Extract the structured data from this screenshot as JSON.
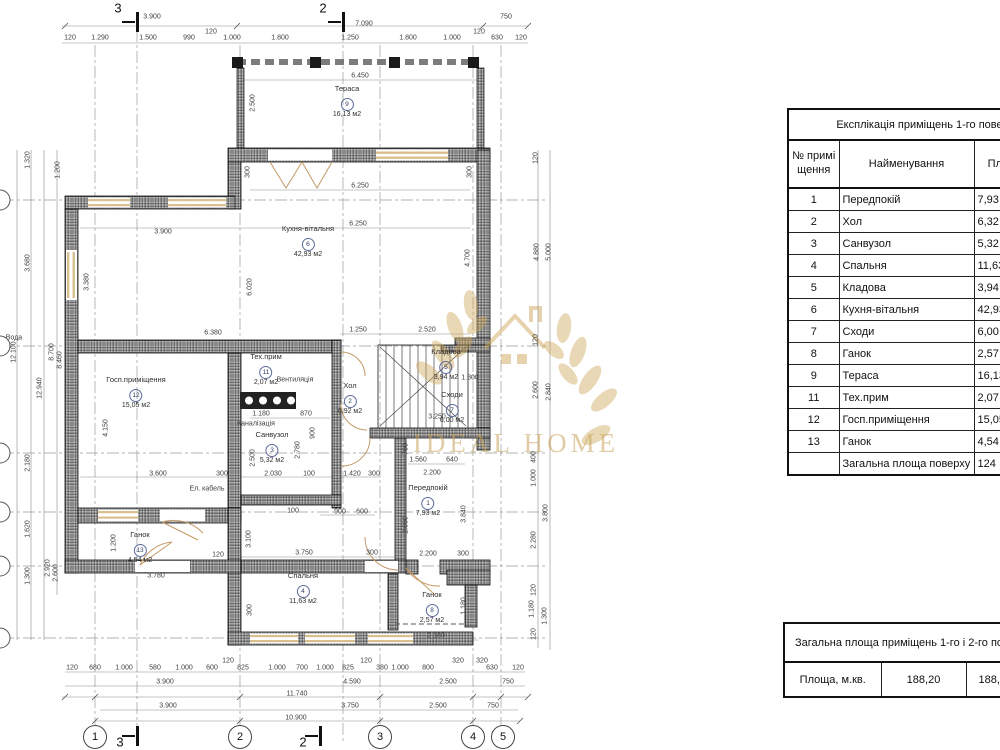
{
  "watermark": {
    "brand": "IDEAL HOME",
    "color": "#c9a45c"
  },
  "tables": {
    "explication": {
      "title": "Експлікація приміщень 1-го поверху",
      "columns": [
        "№ приміщення",
        "Найменування",
        "Площа, м.кв."
      ],
      "rows": [
        {
          "num": "1",
          "name": "Передпокій",
          "area": "7,93"
        },
        {
          "num": "2",
          "name": "Хол",
          "area": "6,32"
        },
        {
          "num": "3",
          "name": "Санвузол",
          "area": "5,32"
        },
        {
          "num": "4",
          "name": "Спальня",
          "area": "11,63"
        },
        {
          "num": "5",
          "name": "Кладова",
          "area": "3,94"
        },
        {
          "num": "6",
          "name": "Кухня-вітальня",
          "area": "42,93"
        },
        {
          "num": "7",
          "name": "Сходи",
          "area": "6,00"
        },
        {
          "num": "8",
          "name": "Ганок",
          "area": "2,57"
        },
        {
          "num": "9",
          "name": "Тераса",
          "area": "16,13"
        },
        {
          "num": "11",
          "name": "Тех.прим",
          "area": "2,07"
        },
        {
          "num": "12",
          "name": "Госп.приміщення",
          "area": "15,05"
        },
        {
          "num": "13",
          "name": "Ганок",
          "area": "4,54"
        },
        {
          "num": "",
          "name": "Загальна площа поверху",
          "area": "124"
        }
      ]
    },
    "total": {
      "title": "Загальна площа приміщень 1-го і 2-го поверхів",
      "row_label": "Площа, м.кв.",
      "value1": "188,20",
      "value2": "188,20"
    }
  },
  "plan": {
    "rooms": [
      {
        "name": "Тераса",
        "num": "9",
        "area": "16,13 м2",
        "x": 347,
        "y": 84
      },
      {
        "name": "Кухня-вітальня",
        "num": "6",
        "area": "42,93 м2",
        "x": 308,
        "y": 224
      },
      {
        "name": "Госп.приміщення",
        "num": "12",
        "area": "15,05 м2",
        "x": 136,
        "y": 375
      },
      {
        "name": "Тех.прим",
        "num": "11",
        "area": "2,07 м2",
        "x": 266,
        "y": 352
      },
      {
        "name": "Хол",
        "num": "2",
        "area": "6,92 м2",
        "x": 350,
        "y": 381
      },
      {
        "name": "Санвузол",
        "num": "3",
        "area": "5,32 м2",
        "x": 272,
        "y": 430
      },
      {
        "name": "Кладова",
        "num": "5",
        "area": "3,94 м2",
        "x": 446,
        "y": 347
      },
      {
        "name": "Сходи",
        "num": "7",
        "area": "6,00 м2",
        "x": 452,
        "y": 390
      },
      {
        "name": "Передпокій",
        "num": "1",
        "area": "7,93 м2",
        "x": 428,
        "y": 483
      },
      {
        "name": "Спальня",
        "num": "4",
        "area": "11,63 м2",
        "x": 303,
        "y": 571
      },
      {
        "name": "Ганок",
        "num": "13",
        "area": "4,54 м2",
        "x": 140,
        "y": 530
      },
      {
        "name": "Ганок",
        "num": "8",
        "area": "2,57 м2",
        "x": 432,
        "y": 590
      }
    ],
    "dims": [
      {
        "t": "3.900",
        "x": 152,
        "y": 17
      },
      {
        "t": "7.090",
        "x": 364,
        "y": 24
      },
      {
        "t": "750",
        "x": 506,
        "y": 17
      },
      {
        "t": "120",
        "x": 70,
        "y": 38
      },
      {
        "t": "1.290",
        "x": 100,
        "y": 38
      },
      {
        "t": "1.500",
        "x": 148,
        "y": 38
      },
      {
        "t": "990",
        "x": 189,
        "y": 38
      },
      {
        "t": "120",
        "x": 211,
        "y": 32
      },
      {
        "t": "1.000",
        "x": 232,
        "y": 38
      },
      {
        "t": "1.800",
        "x": 280,
        "y": 38
      },
      {
        "t": "1.250",
        "x": 350,
        "y": 38
      },
      {
        "t": "1.800",
        "x": 408,
        "y": 38
      },
      {
        "t": "1.000",
        "x": 452,
        "y": 38
      },
      {
        "t": "120",
        "x": 479,
        "y": 32
      },
      {
        "t": "630",
        "x": 497,
        "y": 38
      },
      {
        "t": "120",
        "x": 521,
        "y": 38
      },
      {
        "t": "6.450",
        "x": 360,
        "y": 76
      },
      {
        "t": "2.500",
        "x": 253,
        "y": 103,
        "r": 1
      },
      {
        "t": "6.250",
        "x": 360,
        "y": 186
      },
      {
        "t": "6.250",
        "x": 358,
        "y": 224
      },
      {
        "t": "300",
        "x": 248,
        "y": 172,
        "r": 1
      },
      {
        "t": "300",
        "x": 470,
        "y": 172,
        "r": 1
      },
      {
        "t": "3.900",
        "x": 163,
        "y": 232
      },
      {
        "t": "3.380",
        "x": 87,
        "y": 282,
        "r": 1
      },
      {
        "t": "6.020",
        "x": 250,
        "y": 287,
        "r": 1
      },
      {
        "t": "4.700",
        "x": 468,
        "y": 258,
        "r": 1
      },
      {
        "t": "6.380",
        "x": 213,
        "y": 333
      },
      {
        "t": "1.250",
        "x": 358,
        "y": 330
      },
      {
        "t": "2.520",
        "x": 427,
        "y": 330
      },
      {
        "t": "4.150",
        "x": 106,
        "y": 428,
        "r": 1
      },
      {
        "t": "1.180",
        "x": 261,
        "y": 414
      },
      {
        "t": "870",
        "x": 306,
        "y": 414
      },
      {
        "t": "2.500",
        "x": 253,
        "y": 458,
        "r": 1
      },
      {
        "t": "2.780",
        "x": 298,
        "y": 450,
        "r": 1
      },
      {
        "t": "900",
        "x": 313,
        "y": 433,
        "r": 1
      },
      {
        "t": "3.600",
        "x": 158,
        "y": 474
      },
      {
        "t": "300",
        "x": 222,
        "y": 474
      },
      {
        "t": "2.030",
        "x": 273,
        "y": 474
      },
      {
        "t": "100",
        "x": 309,
        "y": 474
      },
      {
        "t": "1.420",
        "x": 352,
        "y": 474
      },
      {
        "t": "300",
        "x": 374,
        "y": 474
      },
      {
        "t": "Ел. кабель",
        "x": 207,
        "y": 489
      },
      {
        "t": "Вода",
        "x": 14,
        "y": 338
      },
      {
        "t": "Вентиляція",
        "x": 295,
        "y": 380
      },
      {
        "t": "Каналізація",
        "x": 256,
        "y": 424
      },
      {
        "t": "1.800",
        "x": 470,
        "y": 378
      },
      {
        "t": "3.250",
        "x": 437,
        "y": 417
      },
      {
        "t": "1.560",
        "x": 418,
        "y": 460
      },
      {
        "t": "640",
        "x": 452,
        "y": 460
      },
      {
        "t": "2.200",
        "x": 432,
        "y": 473
      },
      {
        "t": "700",
        "x": 406,
        "y": 449,
        "r": 1
      },
      {
        "t": "2.060",
        "x": 406,
        "y": 525,
        "r": 1
      },
      {
        "t": "3.840",
        "x": 464,
        "y": 514,
        "r": 1
      },
      {
        "t": "2.200",
        "x": 428,
        "y": 554
      },
      {
        "t": "300",
        "x": 463,
        "y": 554
      },
      {
        "t": "1.200",
        "x": 114,
        "y": 543,
        "r": 1
      },
      {
        "t": "3.100",
        "x": 249,
        "y": 539,
        "r": 1
      },
      {
        "t": "3.750",
        "x": 304,
        "y": 553
      },
      {
        "t": "300",
        "x": 372,
        "y": 553
      },
      {
        "t": "3.780",
        "x": 156,
        "y": 576
      },
      {
        "t": "120",
        "x": 218,
        "y": 555
      },
      {
        "t": "900",
        "x": 340,
        "y": 512
      },
      {
        "t": "600",
        "x": 362,
        "y": 512
      },
      {
        "t": "100",
        "x": 293,
        "y": 511
      },
      {
        "t": "300",
        "x": 250,
        "y": 610,
        "r": 1
      },
      {
        "t": "1.180",
        "x": 464,
        "y": 606,
        "r": 1
      },
      {
        "t": "2.180",
        "x": 436,
        "y": 636
      },
      {
        "t": "320",
        "x": 482,
        "y": 661
      },
      {
        "t": "120",
        "x": 536,
        "y": 158,
        "r": 1
      },
      {
        "t": "4.880",
        "x": 537,
        "y": 252,
        "r": 1
      },
      {
        "t": "5.000",
        "x": 549,
        "y": 252,
        "r": 1
      },
      {
        "t": "120",
        "x": 536,
        "y": 340,
        "r": 1
      },
      {
        "t": "2.600",
        "x": 536,
        "y": 390,
        "r": 1
      },
      {
        "t": "2.840",
        "x": 549,
        "y": 392,
        "r": 1
      },
      {
        "t": "400",
        "x": 534,
        "y": 457,
        "r": 1
      },
      {
        "t": "1.000",
        "x": 534,
        "y": 478,
        "r": 1
      },
      {
        "t": "3.800",
        "x": 546,
        "y": 513,
        "r": 1
      },
      {
        "t": "2.280",
        "x": 534,
        "y": 540,
        "r": 1
      },
      {
        "t": "120",
        "x": 534,
        "y": 590,
        "r": 1
      },
      {
        "t": "1.180",
        "x": 532,
        "y": 609,
        "r": 1
      },
      {
        "t": "1.300",
        "x": 545,
        "y": 616,
        "r": 1
      },
      {
        "t": "120",
        "x": 534,
        "y": 634,
        "r": 1
      },
      {
        "t": "1.320",
        "x": 28,
        "y": 160,
        "r": 1
      },
      {
        "t": "1.200",
        "x": 58,
        "y": 170,
        "r": 1
      },
      {
        "t": "3.680",
        "x": 28,
        "y": 263,
        "r": 1
      },
      {
        "t": "8.700",
        "x": 52,
        "y": 352,
        "r": 1
      },
      {
        "t": "8.460",
        "x": 60,
        "y": 360,
        "r": 1
      },
      {
        "t": "12.100",
        "x": 14,
        "y": 352,
        "r": 1
      },
      {
        "t": "12.940",
        "x": 40,
        "y": 388,
        "r": 1
      },
      {
        "t": "2.180",
        "x": 28,
        "y": 463,
        "r": 1
      },
      {
        "t": "1.620",
        "x": 28,
        "y": 529,
        "r": 1
      },
      {
        "t": "1.300",
        "x": 28,
        "y": 576,
        "r": 1
      },
      {
        "t": "2.920",
        "x": 48,
        "y": 568,
        "r": 1
      },
      {
        "t": "2.600",
        "x": 56,
        "y": 573,
        "r": 1
      },
      {
        "t": "120",
        "x": 72,
        "y": 668
      },
      {
        "t": "680",
        "x": 95,
        "y": 668
      },
      {
        "t": "1.000",
        "x": 124,
        "y": 668
      },
      {
        "t": "580",
        "x": 155,
        "y": 668
      },
      {
        "t": "1.000",
        "x": 184,
        "y": 668
      },
      {
        "t": "600",
        "x": 212,
        "y": 668
      },
      {
        "t": "120",
        "x": 228,
        "y": 661
      },
      {
        "t": "825",
        "x": 243,
        "y": 668
      },
      {
        "t": "1.000",
        "x": 277,
        "y": 668
      },
      {
        "t": "700",
        "x": 302,
        "y": 668
      },
      {
        "t": "1.000",
        "x": 325,
        "y": 668
      },
      {
        "t": "825",
        "x": 348,
        "y": 668
      },
      {
        "t": "120",
        "x": 366,
        "y": 661
      },
      {
        "t": "380",
        "x": 382,
        "y": 668
      },
      {
        "t": "1.000",
        "x": 400,
        "y": 668
      },
      {
        "t": "800",
        "x": 428,
        "y": 668
      },
      {
        "t": "320",
        "x": 458,
        "y": 661
      },
      {
        "t": "630",
        "x": 492,
        "y": 668
      },
      {
        "t": "120",
        "x": 518,
        "y": 668
      },
      {
        "t": "3.900",
        "x": 165,
        "y": 682
      },
      {
        "t": "4.590",
        "x": 352,
        "y": 682
      },
      {
        "t": "2.500",
        "x": 448,
        "y": 682
      },
      {
        "t": "750",
        "x": 508,
        "y": 682
      },
      {
        "t": "11.740",
        "x": 297,
        "y": 694
      },
      {
        "t": "3.900",
        "x": 168,
        "y": 706
      },
      {
        "t": "3.750",
        "x": 350,
        "y": 706
      },
      {
        "t": "2.500",
        "x": 438,
        "y": 706
      },
      {
        "t": "750",
        "x": 493,
        "y": 706
      },
      {
        "t": "10.900",
        "x": 296,
        "y": 718
      }
    ],
    "grid_bottom": [
      {
        "t": "1",
        "x": 95,
        "y": 737
      },
      {
        "t": "2",
        "x": 240,
        "y": 737
      },
      {
        "t": "3",
        "x": 380,
        "y": 737
      },
      {
        "t": "4",
        "x": 473,
        "y": 737
      },
      {
        "t": "5",
        "x": 503,
        "y": 737
      }
    ],
    "axis_left": [
      {
        "x": 0,
        "y": 200
      },
      {
        "x": 0,
        "y": 346
      },
      {
        "x": 0,
        "y": 453
      },
      {
        "x": 0,
        "y": 512
      },
      {
        "x": 0,
        "y": 566
      },
      {
        "x": 0,
        "y": 638
      }
    ],
    "section_labels": [
      {
        "t": "3",
        "x": 118,
        "y": 8
      },
      {
        "t": "2",
        "x": 323,
        "y": 8
      },
      {
        "t": "3",
        "x": 120,
        "y": 742
      },
      {
        "t": "2",
        "x": 303,
        "y": 742
      }
    ],
    "section_bars": [
      {
        "x": 136,
        "y": 12
      },
      {
        "x": 342,
        "y": 12
      },
      {
        "x": 136,
        "y": 726
      },
      {
        "x": 319,
        "y": 726
      }
    ],
    "section_arrows": [
      {
        "x": 122,
        "y": 21
      },
      {
        "x": 328,
        "y": 21
      },
      {
        "x": 122,
        "y": 735
      },
      {
        "x": 305,
        "y": 735
      }
    ]
  }
}
